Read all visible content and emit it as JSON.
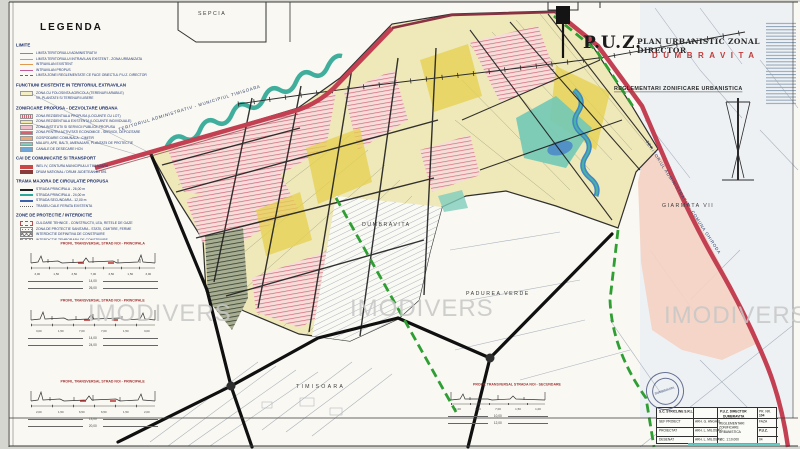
{
  "watermark": {
    "text": "IMODIVERS"
  },
  "title": {
    "puz": "P.U.Z.",
    "main": "PLAN URBANISTIC ZONAL DIRECTOR",
    "locality": "DUMBRAVITA",
    "subtitle": "REGLEMENTARI ZONIFICARE URBANISTICA"
  },
  "legend": {
    "title": "LEGENDA",
    "sections": [
      {
        "heading": "LIMITE",
        "rows": [
          {
            "sym": "ln-gray",
            "label": "LIMITA TERITORIULUI ADMINISTRATIV"
          },
          {
            "sym": "ln-pink",
            "label": "LIMITA TERITORIULUI INTRAVILAN EXISTENT - ZONA URBANIZATA"
          },
          {
            "sym": "ln-orange",
            "label": "INTRAVILAN EXISTENT"
          },
          {
            "sym": "ln-magenta",
            "label": "INTRAVILAN PROPUS"
          },
          {
            "sym": "ln-reddash",
            "label": "LIMITA ZONEI REGLEMENTATE CE FACE OBIECTUL P.U.Z. DIRECTOR"
          }
        ]
      },
      {
        "heading": "FUNCTIUNI EXISTENTE IN TERITORIUL EXTRAVILAN",
        "rows": [
          {
            "sym": "sw-yellowpale",
            "label": "ZONA CU FOLOSINTA AGRICOLA (TERENURI ARABILE)"
          },
          {
            "sym": "none",
            "label": "VII, PLANTATII SI TERENURI LIBERE"
          }
        ]
      },
      {
        "heading": "ZONIFICARE PROPUSA - DEZVOLTARE URBANA",
        "rows": [
          {
            "sym": "sw-hatchpink",
            "label": "ZONA REZIDENTIALA PROPUSA (LOCUINTE CU LOT)"
          },
          {
            "sym": "sw-yellow",
            "label": "ZONA REZIDENTIALA EXISTENTA (LOCUINTE INDIVIDUALE)"
          },
          {
            "sym": "sw-pink",
            "label": "ZONA INSTITUTII SI SERVICII PUBLICE PROPUSA"
          },
          {
            "sym": "sw-red",
            "label": "ZONA PENTRU ACTIVITATI ECONOMICE - SERVICII, DEPOZITARE"
          },
          {
            "sym": "sw-orange",
            "label": "GOSPODARIE COMUNALA - CIMITIR"
          },
          {
            "sym": "sw-teal",
            "label": "MALURI, APE, BALTI, AMENAJARI, PLANTATII DE PROTECTIE"
          },
          {
            "sym": "sw-blue",
            "label": "CANALE DE DESECARE HCN"
          }
        ]
      },
      {
        "heading": "CAI DE COMUNICATIE SI TRANSPORT",
        "rows": [
          {
            "sym": "sw-red2",
            "label": "INEL IV, CENTURA MUNICIPIULUI TIMISOARA"
          },
          {
            "sym": "sw-dkred",
            "label": "DRUM NATIONAL / DRUM JUDETEAN DJ 691"
          }
        ]
      },
      {
        "heading": "TRAMA MAJORA DE CIRCULATIE PROPUSA",
        "rows": [
          {
            "sym": "ln-blackthick",
            "label": "STRADA PRINCIPALA - 26,00 m"
          },
          {
            "sym": "ln-teal",
            "label": "STRADA PRINCIPALA - 24,00 m"
          },
          {
            "sym": "ln-blue",
            "label": "STRADA SECUNDARA - 12,00 m"
          },
          {
            "sym": "ln-gray2",
            "label": "TRASEU CALE FERATA EXISTENTA"
          }
        ]
      },
      {
        "heading": "ZONE DE PROTECTIE / INTERDICTIE",
        "rows": [
          {
            "sym": "pat-dash",
            "label": "CULOARE TEHNICE - CONSTRUCTII, LEA, RETELE DE GAZE"
          },
          {
            "sym": "pat-dots",
            "label": "ZONA DE PROTECTIE SANITARA - STATII, CIMITIRE, FERME"
          },
          {
            "sym": "pat-cross",
            "label": "INTERDICTIE DEFINITIVA DE CONSTRUIRE"
          },
          {
            "sym": "pat-zig",
            "label": "INTERDICTIE TEMPORARA DE CONSTRUIRE"
          }
        ]
      }
    ]
  },
  "map_labels": {
    "sepcia": "SEPCIA",
    "dumbravita": "DUMBRAVITA",
    "padurea_verde": "PADUREA VERDE",
    "timisoara": "TIMISOARA",
    "giarmata": "GIARMATA VII",
    "admin_left": "TERITORIUL ADMINISTRATIV - MUNICIPIUL TIMISOARA",
    "admin_right": "TERITORIUL ADMINISTRATIV - COMUNA GHIRODA"
  },
  "profiles": [
    {
      "title": "PROFIL TRANSVERSAL STRAD NOI - PRINCIPALA",
      "dims": [
        "3,00",
        "1,50",
        "3,50",
        "7,00",
        "3,50",
        "1,50",
        "3,00"
      ],
      "mid": "14,00",
      "total": "26,00"
    },
    {
      "title": "PROFIL TRANSVERSAL STRAD NOI - PRINCIPALE",
      "dims": [
        "3,00",
        "1,50",
        "7,00",
        "7,00",
        "1,50",
        "3,00"
      ],
      "mid": "14,00",
      "total": "24,00"
    },
    {
      "title": "PROFIL TRANSVERSAL STRAD NOI - PRINCIPALE",
      "dims": [
        "2,00",
        "1,50",
        "6,50",
        "6,50",
        "1,50",
        "2,00"
      ],
      "mid": "13,00",
      "total": "20,00"
    },
    {
      "title": "PROFIL TRANSVERSAL STRADA NOI - SECUNDARE",
      "dims": [
        "1,00",
        "1,50",
        "7,00",
        "1,50",
        "1,00"
      ],
      "mid": "10,00",
      "total": "12,00"
    }
  ],
  "title_block": {
    "company": "S.C. STRICLINE S.R.L.",
    "project": "P.U.Z. DIRECTOR",
    "locality": "DUMBRAVITA",
    "drawing": "REGLEMENTARI ZONIFICARE URBANISTICA",
    "scale": "SC. 1:10.000",
    "roles": [
      {
        "role": "SEF PROIECT",
        "name": "ARH. G. ANGHEL"
      },
      {
        "role": "PROIECTAT",
        "name": "ARH. L. MILOSAV"
      },
      {
        "role": "DESENAT",
        "name": "ARH. L. MILOSAV"
      }
    ],
    "proj_label": "PR. NR.",
    "proj_no": "104",
    "faza_label": "FAZA",
    "faza": "P.U.Z.",
    "plansa_label": "PL. NR.",
    "plansa": "04"
  },
  "stamp": {
    "label": "DUMBRAVITA"
  },
  "colors": {
    "red_road": "#c24052",
    "green_boundary": "#2f9e33",
    "teal_water": "#3fae9c",
    "zone_yellow": "#efe8b8",
    "salmon_zone": "#f4d2c2",
    "title_red": "#c23b3b"
  }
}
